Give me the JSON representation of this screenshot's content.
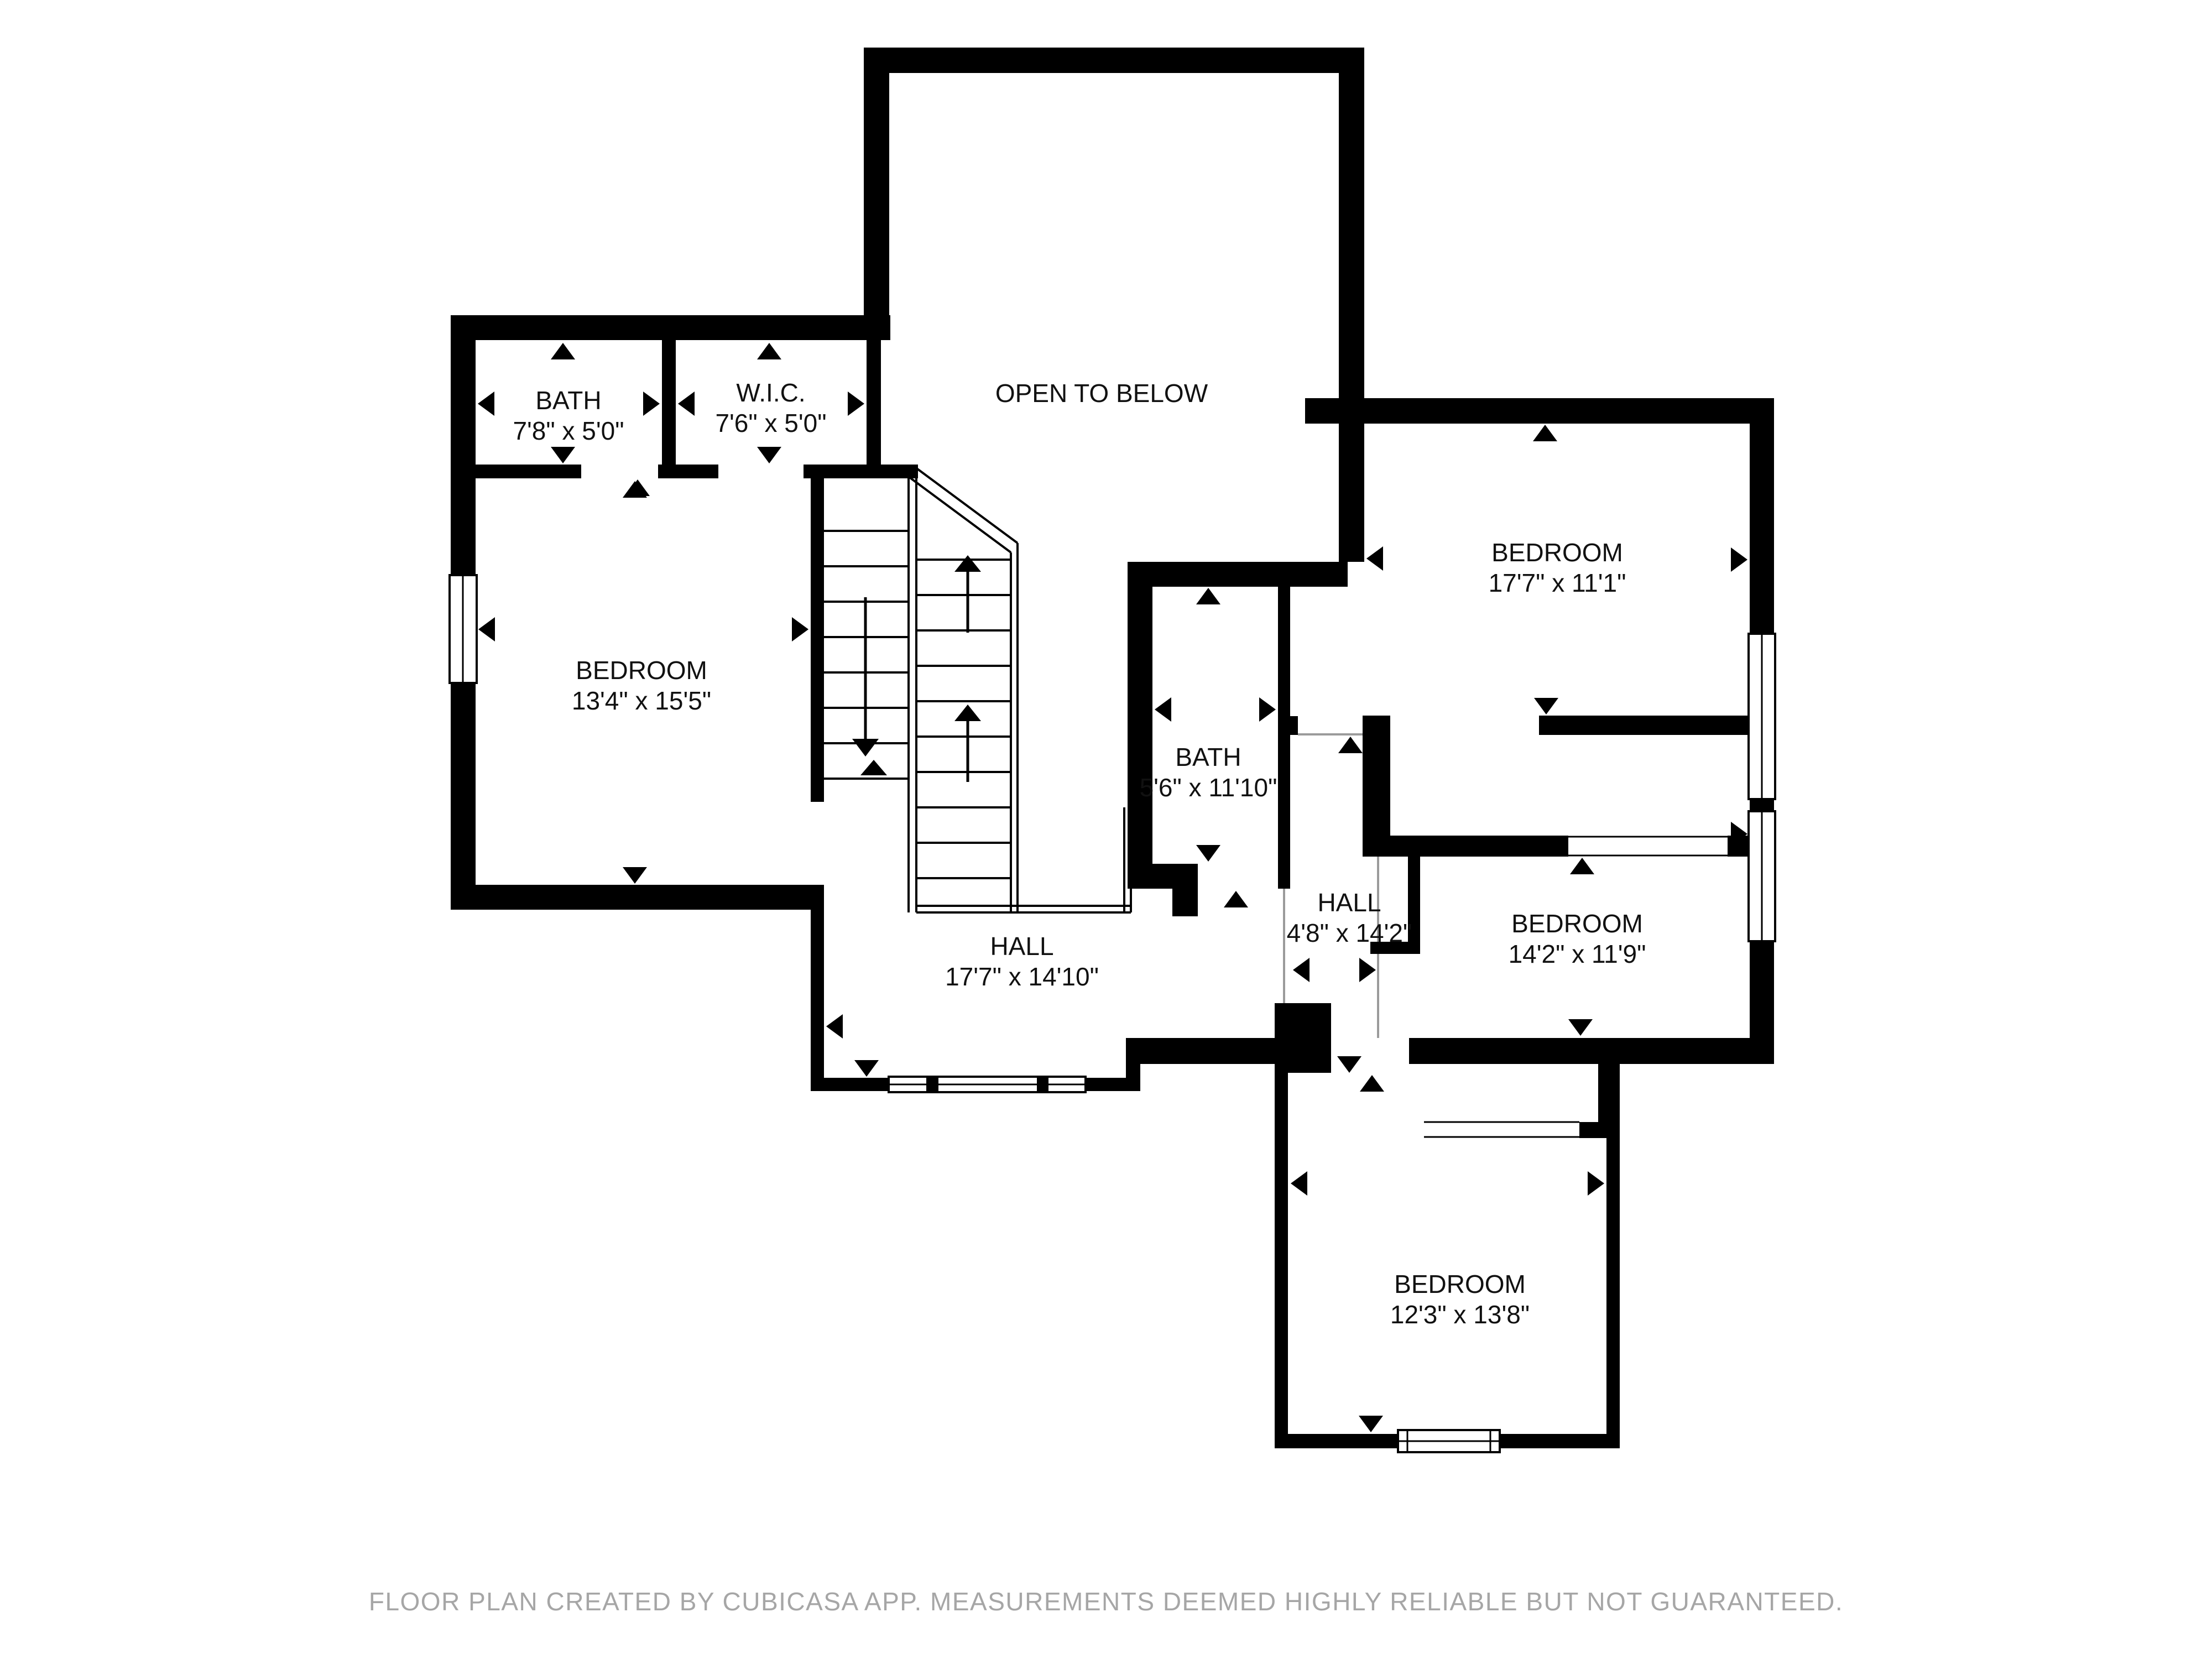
{
  "rooms": [
    {
      "id": "bath-upper-left",
      "name": "BATH",
      "dims": "7'8\" x 5'0\""
    },
    {
      "id": "wic",
      "name": "W.I.C.",
      "dims": "7'6\" x 5'0\""
    },
    {
      "id": "open-to-below",
      "name": "OPEN TO BELOW",
      "dims": ""
    },
    {
      "id": "bedroom-top-right",
      "name": "BEDROOM",
      "dims": "17'7\" x 11'1\""
    },
    {
      "id": "bedroom-left",
      "name": "BEDROOM",
      "dims": "13'4\" x 15'5\""
    },
    {
      "id": "bath-center",
      "name": "BATH",
      "dims": "5'6\" x 11'10\""
    },
    {
      "id": "hall-small",
      "name": "HALL",
      "dims": "4'8\" x 14'2\""
    },
    {
      "id": "bedroom-right",
      "name": "BEDROOM",
      "dims": "14'2\" x 11'9\""
    },
    {
      "id": "hall-main",
      "name": "HALL",
      "dims": "17'7\" x 14'10\""
    },
    {
      "id": "bedroom-bottom",
      "name": "BEDROOM",
      "dims": "12'3\" x 13'8\""
    }
  ],
  "footer": "FLOOR PLAN CREATED BY CUBICASA APP. MEASUREMENTS DEEMED HIGHLY RELIABLE BUT NOT GUARANTEED.",
  "colors": {
    "walls": "#000000",
    "open_boundary": "#9b9b9b",
    "footer_text": "#a6a6a6",
    "background": "#ffffff"
  }
}
